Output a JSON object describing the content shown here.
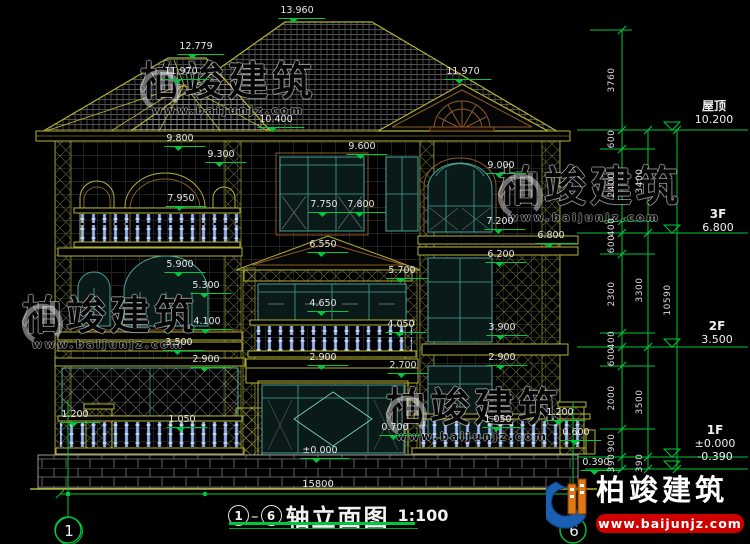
{
  "title": {
    "axis_start": "1",
    "axis_end": "6",
    "name": "轴立面图",
    "scale": "1:100"
  },
  "bottom_dim": "15800",
  "axes": {
    "left_bubble": "1",
    "right_bubble": "6"
  },
  "floors": [
    {
      "name": "屋顶",
      "elev": "10.200"
    },
    {
      "name": "3F",
      "elev": "6.800"
    },
    {
      "name": "2F",
      "elev": "3.500"
    },
    {
      "name": "1F",
      "elev": "±0.000",
      "elev_below": "-0.390"
    }
  ],
  "levels": [
    {
      "t": "13.960",
      "x": 302,
      "y": 6
    },
    {
      "t": "12.779",
      "x": 201,
      "y": 42
    },
    {
      "t": "11.970",
      "x": 186,
      "y": 67
    },
    {
      "t": "11.970",
      "x": 468,
      "y": 67
    },
    {
      "t": "10.400",
      "x": 281,
      "y": 115
    },
    {
      "t": "9.800",
      "x": 185,
      "y": 134
    },
    {
      "t": "9.600",
      "x": 367,
      "y": 142
    },
    {
      "t": "9.300",
      "x": 226,
      "y": 150
    },
    {
      "t": "9.000",
      "x": 506,
      "y": 161
    },
    {
      "t": "7.950",
      "x": 186,
      "y": 194
    },
    {
      "t": "7.750",
      "x": 329,
      "y": 200
    },
    {
      "t": "7.800",
      "x": 366,
      "y": 200
    },
    {
      "t": "7.200",
      "x": 505,
      "y": 217
    },
    {
      "t": "6.800",
      "x": 556,
      "y": 231
    },
    {
      "t": "6.550",
      "x": 328,
      "y": 240
    },
    {
      "t": "6.200",
      "x": 506,
      "y": 250
    },
    {
      "t": "5.900",
      "x": 185,
      "y": 260
    },
    {
      "t": "5.700",
      "x": 407,
      "y": 266
    },
    {
      "t": "5.300",
      "x": 211,
      "y": 281
    },
    {
      "t": "4.650",
      "x": 328,
      "y": 299
    },
    {
      "t": "4.100",
      "x": 212,
      "y": 317
    },
    {
      "t": "4.050",
      "x": 406,
      "y": 320
    },
    {
      "t": "3.900",
      "x": 507,
      "y": 323
    },
    {
      "t": "3.500",
      "x": 184,
      "y": 338
    },
    {
      "t": "2.900",
      "x": 211,
      "y": 355
    },
    {
      "t": "2.900",
      "x": 328,
      "y": 353
    },
    {
      "t": "2.900",
      "x": 507,
      "y": 353
    },
    {
      "t": "2.700",
      "x": 408,
      "y": 361
    },
    {
      "t": "1.200",
      "x": 80,
      "y": 410
    },
    {
      "t": "1.050",
      "x": 187,
      "y": 415
    },
    {
      "t": "1.050",
      "x": 503,
      "y": 415
    },
    {
      "t": "1.200",
      "x": 565,
      "y": 408
    },
    {
      "t": "0.700",
      "x": 400,
      "y": 423
    },
    {
      "t": "0.600",
      "x": 581,
      "y": 428
    },
    {
      "t": "±0.000",
      "x": 325,
      "y": 446
    },
    {
      "t": "0.390",
      "x": 601,
      "y": 458
    }
  ],
  "dim_chains": {
    "inner": [
      {
        "t": "3760",
        "x": 612,
        "y": 80
      },
      {
        "t": "600",
        "x": 612,
        "y": 139
      },
      {
        "t": "2400",
        "x": 612,
        "y": 185
      },
      {
        "t": "400",
        "x": 612,
        "y": 227
      },
      {
        "t": "600",
        "x": 612,
        "y": 244
      },
      {
        "t": "2300",
        "x": 612,
        "y": 294
      },
      {
        "t": "400",
        "x": 612,
        "y": 340
      },
      {
        "t": "600",
        "x": 612,
        "y": 357
      },
      {
        "t": "2000",
        "x": 612,
        "y": 398
      },
      {
        "t": "900",
        "x": 612,
        "y": 443
      },
      {
        "t": "390",
        "x": 612,
        "y": 463
      }
    ],
    "middle": [
      {
        "t": "3400",
        "x": 640,
        "y": 181
      },
      {
        "t": "3300",
        "x": 640,
        "y": 290
      },
      {
        "t": "3500",
        "x": 640,
        "y": 402
      },
      {
        "t": "390",
        "x": 640,
        "y": 463
      }
    ],
    "overall": [
      {
        "t": "10590",
        "x": 668,
        "y": 300
      }
    ]
  },
  "watermark": {
    "brand": "柏竣建筑",
    "url": "www.baijunjz.com"
  },
  "logo": {
    "brand": "柏竣建筑",
    "url": "www.baijunjz.com"
  },
  "colors": {
    "cad_yellow": "#b5b232",
    "dim_green": "#00c83c",
    "text_white": "#e8e8e8",
    "window_teal": "#4aa398",
    "trim_brown": "#8a5a28",
    "baluster_blue": "#9db8e8",
    "logo_red": "#cf0000",
    "logo_blue": "#1a5fb4",
    "logo_orange": "#e07818"
  }
}
